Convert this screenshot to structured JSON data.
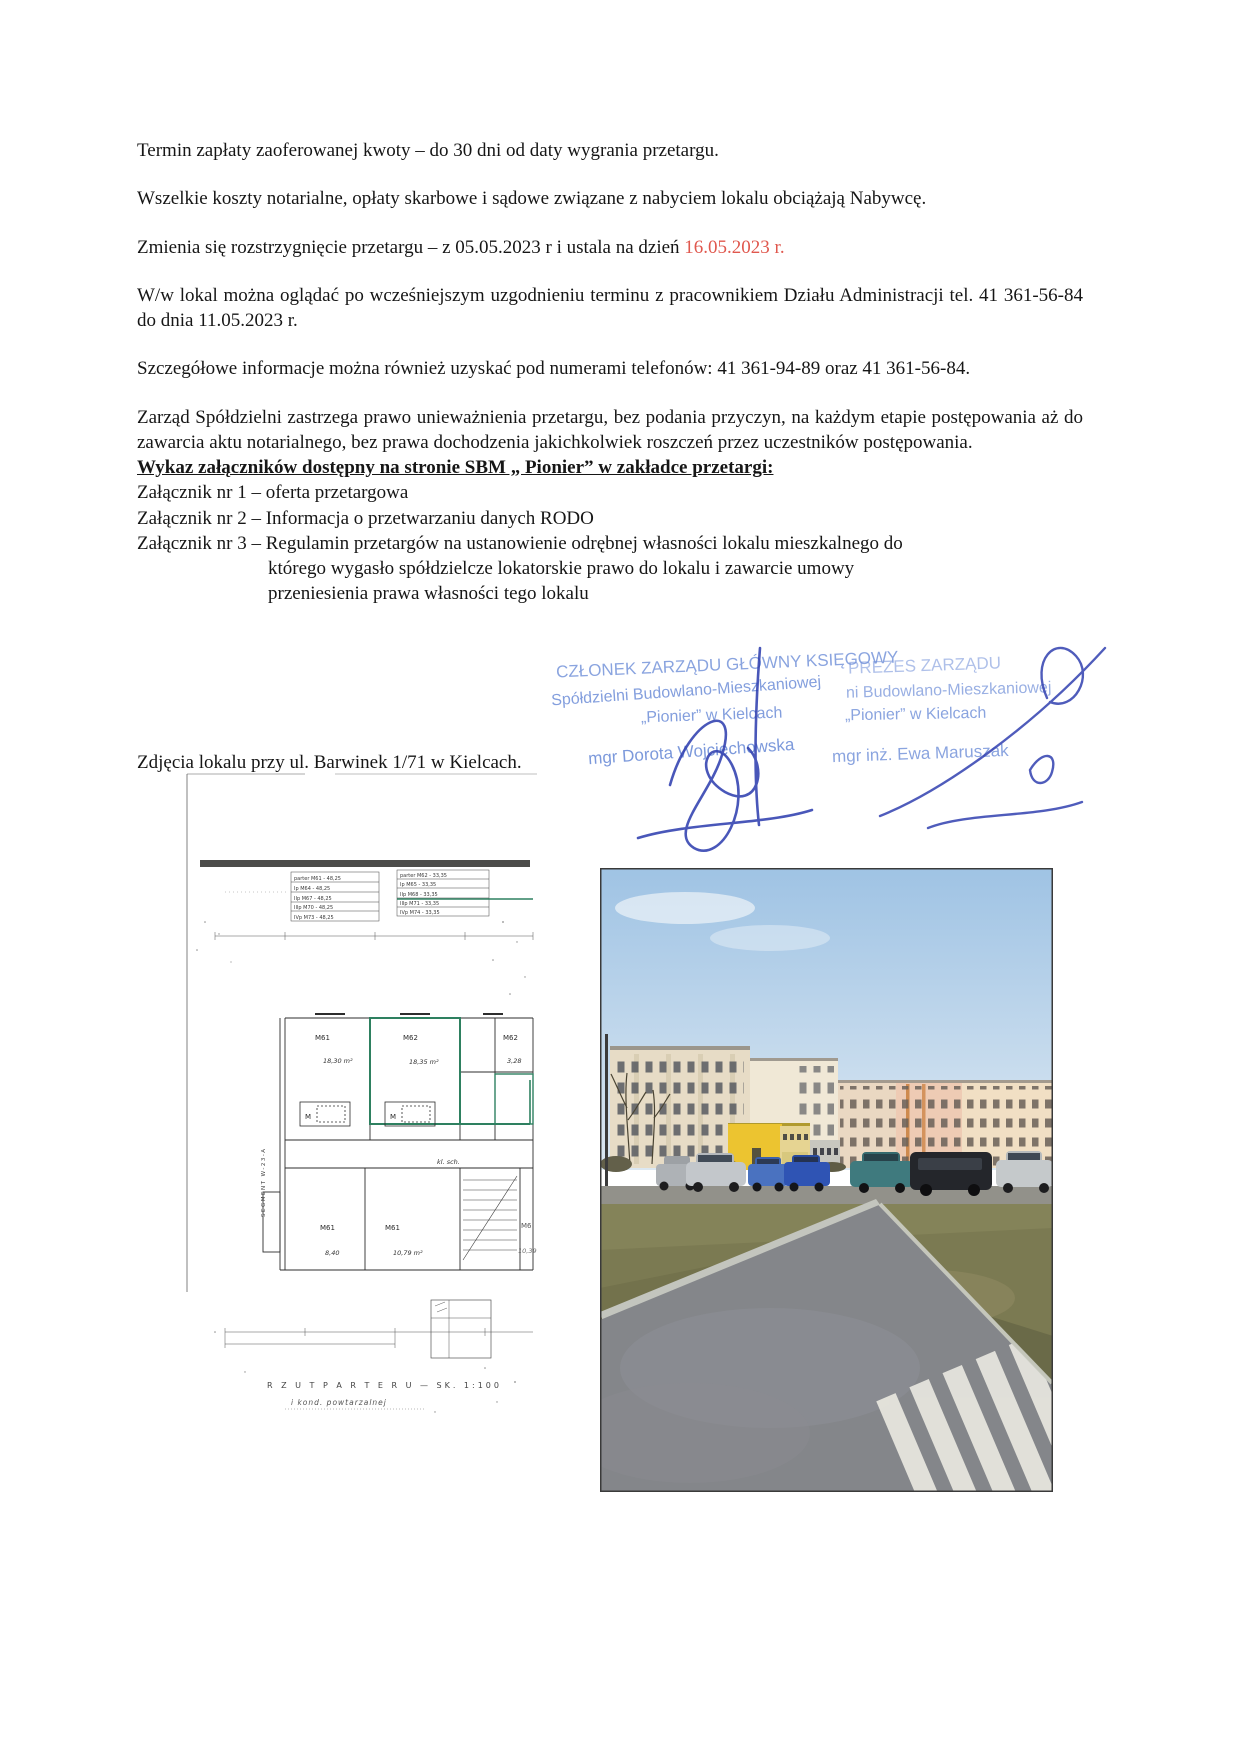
{
  "document": {
    "paragraphs": {
      "p1": "Termin zapłaty zaoferowanej kwoty – do 30 dni od daty wygrania przetargu.",
      "p2": "Wszelkie koszty notarialne, opłaty skarbowe i sądowe związane z nabyciem lokalu obciążają Nabywcę.",
      "p3_prefix": "Zmienia się rozstrzygnięcie przetargu – z 05.05.2023 r i ustala na dzień ",
      "p3_red": "16.05.2023 r.",
      "p4": "W/w lokal można oglądać po wcześniejszym uzgodnieniu terminu z pracownikiem Działu Administracji tel. 41 361-56-84 do dnia 11.05.2023 r.",
      "p5": "Szczegółowe informacje można również uzyskać pod numerami telefonów: 41 361-94-89 oraz 41 361-56-84.",
      "p6": "Zarząd Spółdzielni zastrzega prawo unieważnienia przetargu, bez podania przyczyn, na każdym etapie postępowania aż do zawarcia aktu notarialnego, bez prawa dochodzenia jakichkolwiek roszczeń przez uczestników postępowania."
    },
    "attachments": {
      "heading": "Wykaz załączników dostępny na stronie SBM „ Pionier” w zakładce przetargi:",
      "item1": "Załącznik nr 1 – oferta przetargowa",
      "item2": "Załącznik nr 2 – Informacja o przetwarzaniu danych RODO",
      "item3_line1": "Załącznik nr 3 – Regulamin przetargów na ustanowienie odrębnej własności lokalu mieszkalnego do",
      "item3_line2": "którego wygasło spółdzielcze lokatorskie prawo do lokalu i zawarcie umowy",
      "item3_line3": "przeniesienia prawa własności tego lokalu"
    },
    "photos_caption": "Zdjęcia lokalu przy ul. Barwinek 1/71 w Kielcach."
  },
  "stamps": {
    "left": {
      "line1": "CZŁONEK ZARZĄDU  GŁÓWNY KSIĘGOWY",
      "line2": "Spółdzielni Budowlano-Mieszkaniowej",
      "line3": "„Pionier” w Kielcach",
      "name": "mgr Dorota Wojciechowska"
    },
    "right": {
      "line1": "PREZES ZARZĄDU",
      "line2": "ni Budowlano-Mieszkaniowej",
      "line3": "„Pionier” w Kielcach",
      "name": "mgr inż. Ewa Maruszak"
    }
  },
  "floorplan": {
    "table_left": [
      "parter M61 - 48,25",
      "Ip  M64 - 48,25",
      "IIp M67 - 48,25",
      "IIIp M70 - 48,25",
      "IVp M73 - 48,25"
    ],
    "table_right": [
      "parter M62 - 33,35",
      "Ip  M65 - 33,35",
      "IIp M68 - 33,35",
      "IIIp M71 - 33,35",
      "IVp M74 - 33,35"
    ],
    "rooms": {
      "m61_top": {
        "name": "M61",
        "area": "18,30 m²"
      },
      "m62_top": {
        "name": "M62",
        "area": "18,35 m²"
      },
      "m62_right": {
        "name": "M62",
        "area": "3,28"
      },
      "m61_bl": {
        "name": "M61",
        "area": "8,40"
      },
      "m61_bc": {
        "name": "M61",
        "area": "10,79 m²"
      },
      "cut": {
        "name": "M6",
        "area": "10,39"
      }
    },
    "m_label": "M",
    "klsch": "kl. sch.",
    "segment": "SEGMENT W-23-A",
    "caption1": "R Z U T   P A R T E R U  —  SK. 1:100",
    "caption2": "i kond. powtarzalnej"
  },
  "colors": {
    "highlight_red": "#e0584e",
    "stamp_blue": "#6e8ed8",
    "signature_blue": "#3140b0",
    "plan_green": "#2e8060",
    "photo_sky": "#a5c6e6",
    "photo_grass": "#7b7a52",
    "photo_road": "#84868a",
    "photo_yellow_building": "#ecc430"
  }
}
